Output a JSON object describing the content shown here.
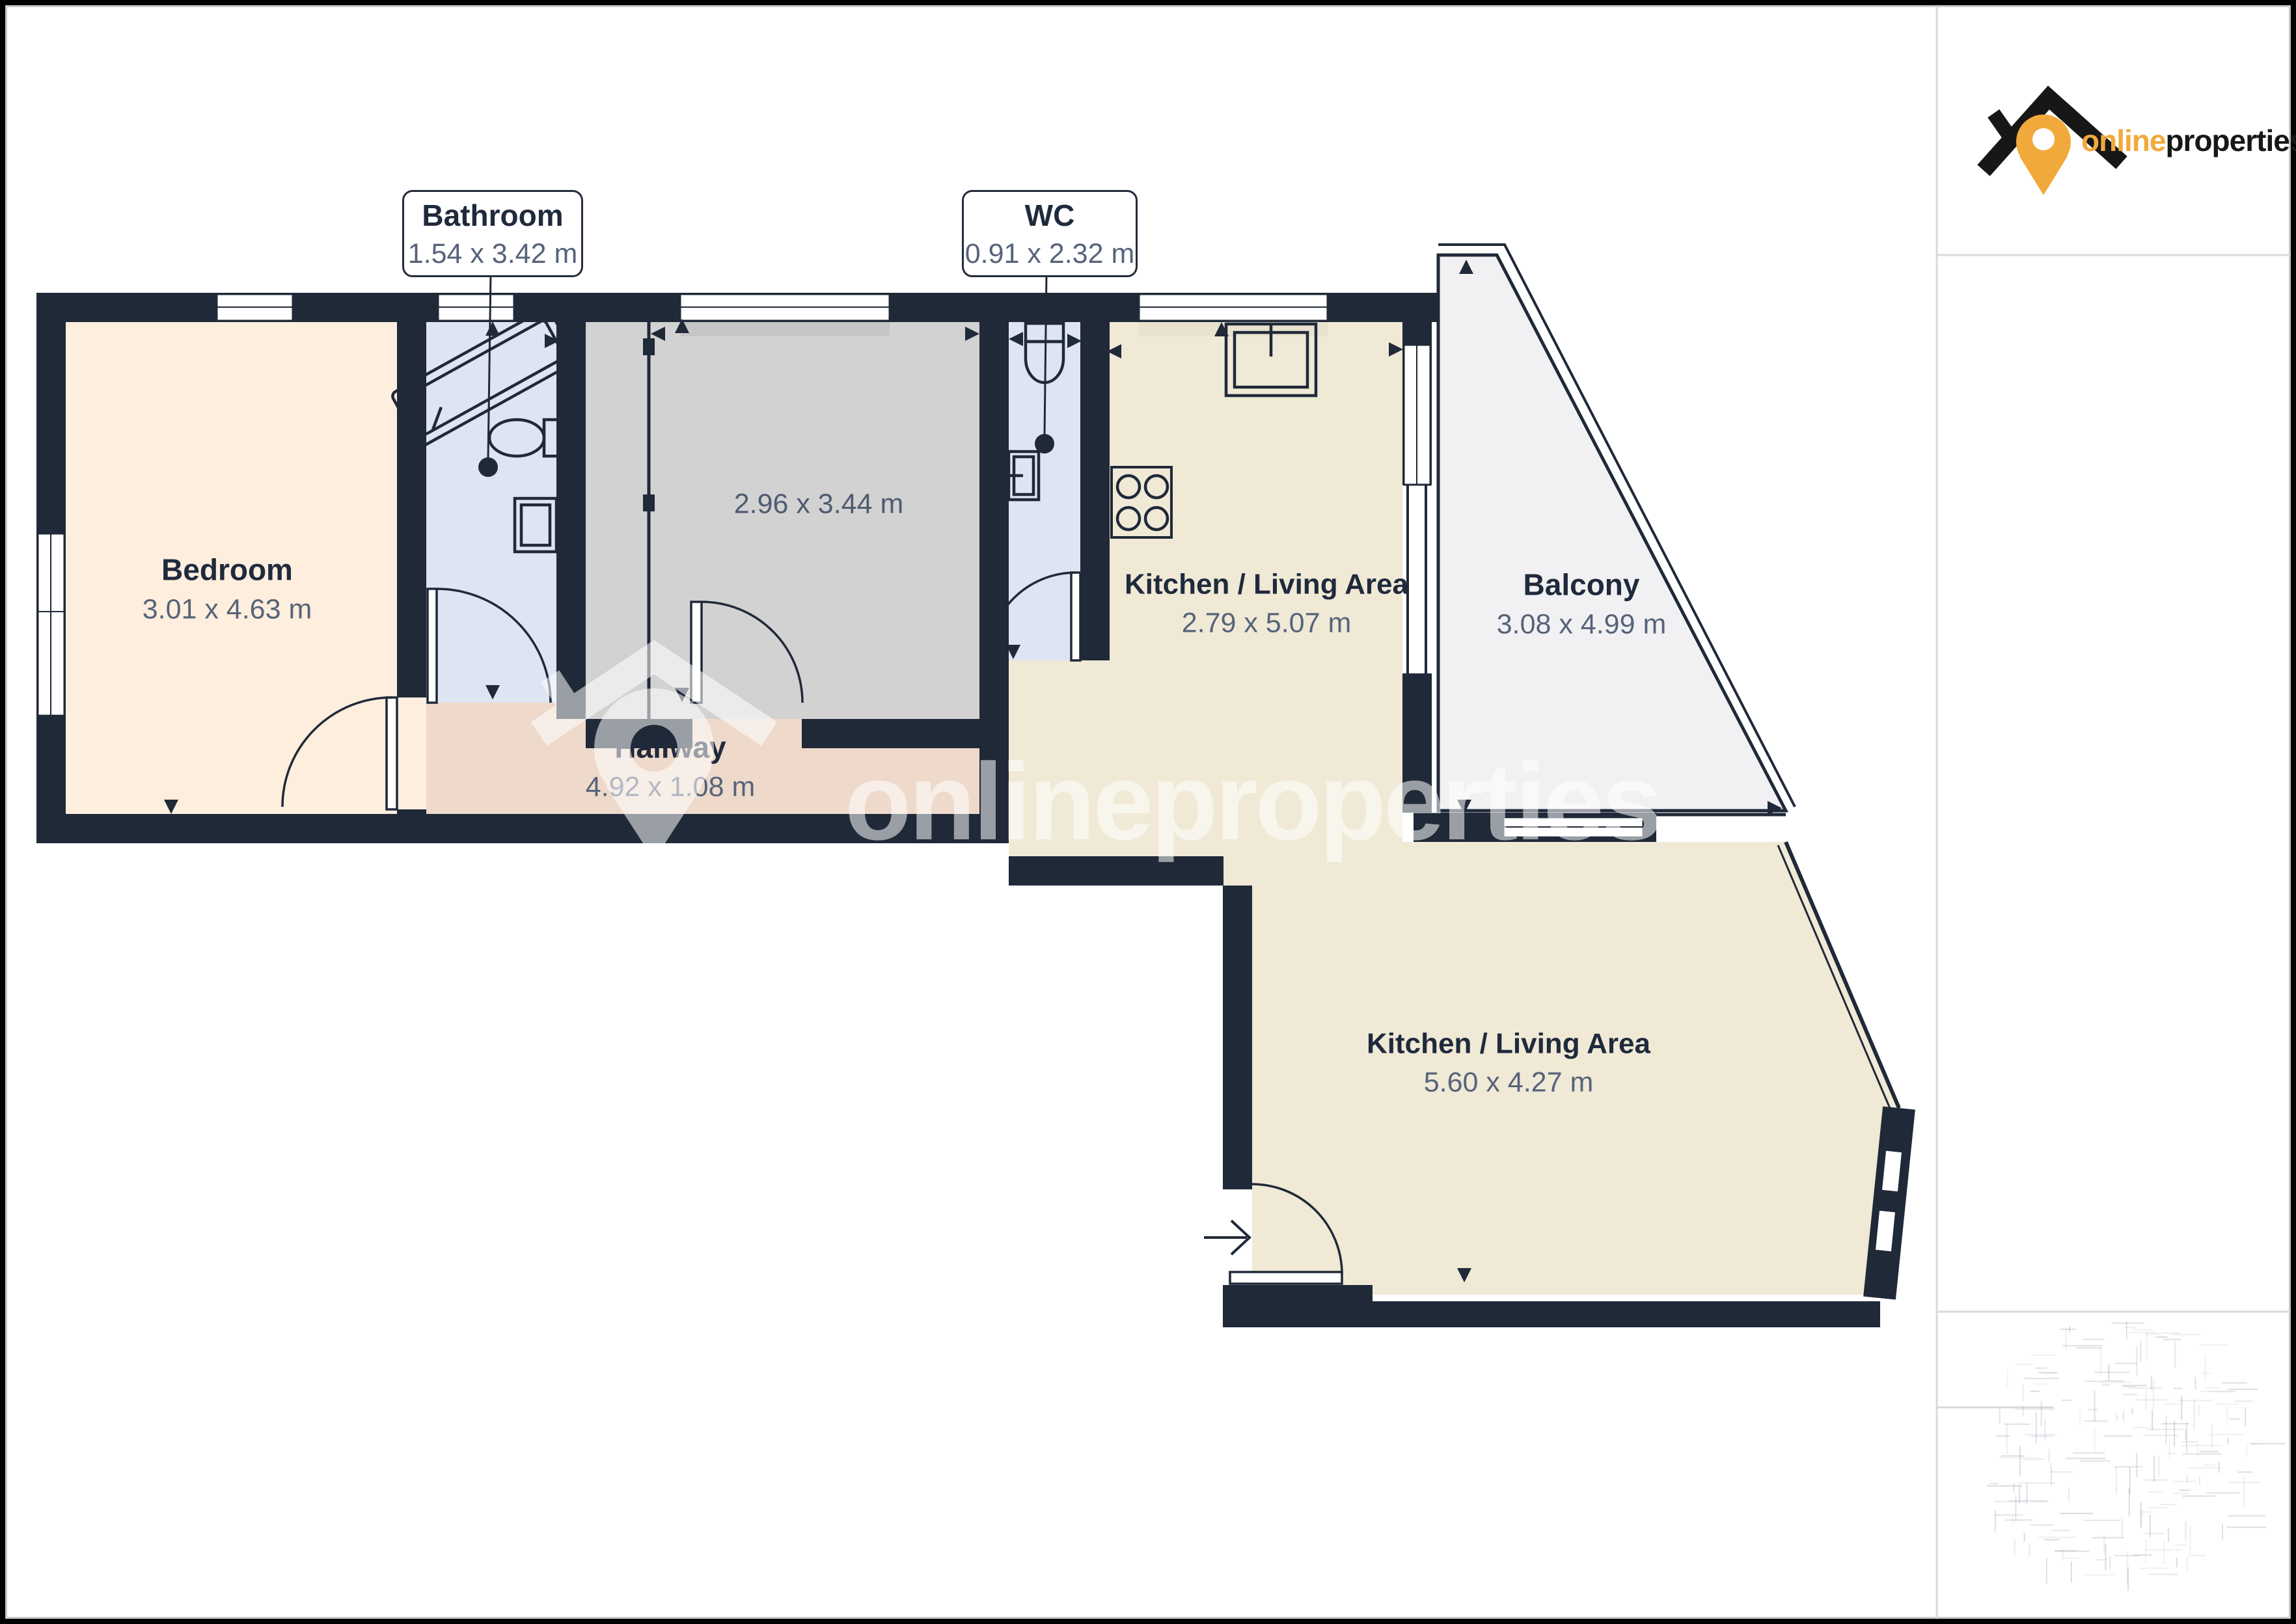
{
  "colors": {
    "wall": "#202938",
    "bedroom": "#fdeedd",
    "bathroom": "#dee4f1",
    "gray_room": "#d2d2d2",
    "hallway": "#eed9cb",
    "kitchen": "#efe9d6",
    "balcony": "#f1f1f3",
    "label_title": "#1f2a3c",
    "label_dims": "#56637a",
    "logo_orange": "#f2a93b",
    "logo_black": "#171717",
    "line_gray": "#d9d9d9"
  },
  "logo": {
    "part1": "online",
    "part2": "properties"
  },
  "watermark": {
    "text": "onlineproperties"
  },
  "callouts": {
    "bathroom": {
      "title": "Bathroom",
      "dims": "1.54 x 3.42 m"
    },
    "wc": {
      "title": "WC",
      "dims": "0.91 x 2.32 m"
    }
  },
  "rooms": {
    "bedroom": {
      "title": "Bedroom",
      "dims": "3.01 x 4.63 m"
    },
    "gray_room": {
      "dims": "2.96 x 3.44 m"
    },
    "kitchen_upper": {
      "title": "Kitchen / Living Area",
      "dims": "2.79 x 5.07 m"
    },
    "balcony": {
      "title": "Balcony",
      "dims": "3.08 x 4.99 m"
    },
    "hallway": {
      "title": "Hallway",
      "dims": "4.92 x 1.08 m"
    },
    "kitchen_lower": {
      "title": "Kitchen / Living Area",
      "dims": "5.60 x 4.27 m"
    }
  }
}
